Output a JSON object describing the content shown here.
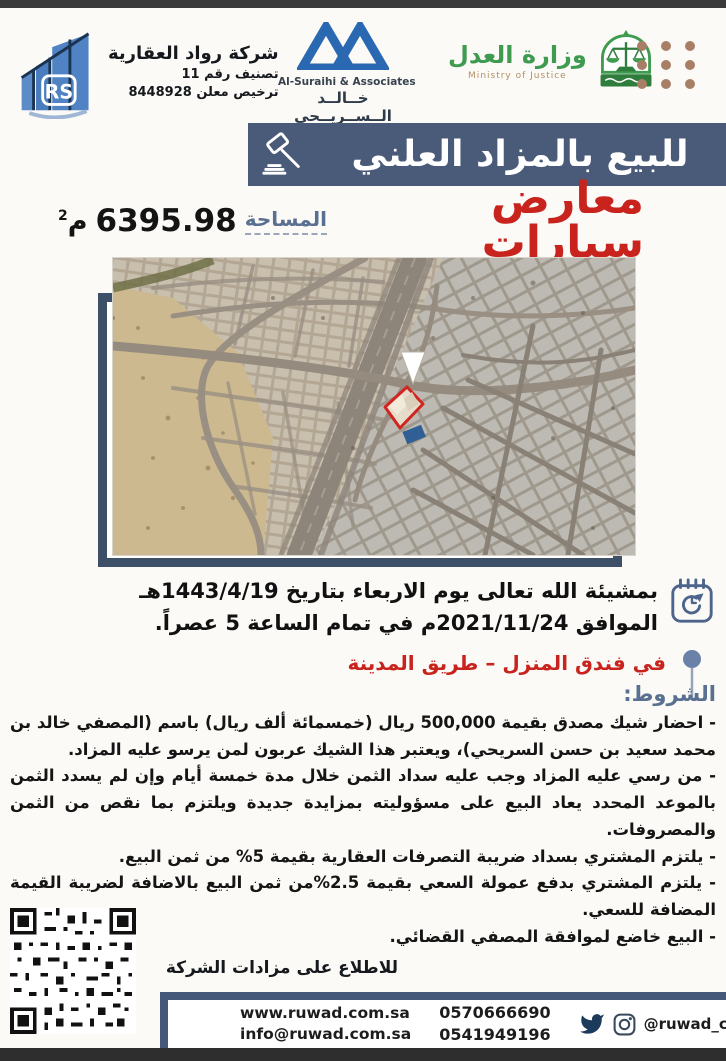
{
  "header": {
    "company": {
      "name": "شركة رواد العقارية",
      "classification": "تصنيف رقم 11",
      "license": "ترخيص معلن 8448928",
      "logo_initials": "RS"
    },
    "lawfirm": {
      "name_en": "Al-Suraihi & Associates",
      "name_ar": "خــالــد الــســريــحي",
      "tagline_ar": "محامون ومستشارون",
      "tagline_en": "Law Firm"
    },
    "ministry": {
      "name_ar": "وزارة العدل",
      "name_en": "Ministry of Justice"
    }
  },
  "banner": {
    "title": "للبيع بالمزاد العلني"
  },
  "subject": {
    "title": "معارض سيارات",
    "area_label": "المساحة",
    "area_value": "6395.98",
    "area_unit": "م",
    "area_sup": "2"
  },
  "auction": {
    "date_line1": "بمشيئة الله تعالى يوم الاربعاء بتاريخ 1443/4/19هـ",
    "date_line2": "الموافق 2021/11/24م في تمام الساعة 5 عصراً.",
    "location": "في فندق المنزل – طريق المدينة"
  },
  "conditions": {
    "heading": "الشروط:",
    "items": [
      "- احضار شيك مصدق بقيمة 500,000 ريال (خمسمائة ألف ريال) باسم (المصفي خالد بن محمد سعيد بن حسن السريحي)، ويعتبر هذا الشيك عربون لمن يرسو عليه المزاد.",
      "- من رسي عليه المزاد وجب عليه سداد الثمن خلال مدة خمسة أيام وإن لم يسدد الثمن بالموعد المحدد يعاد البيع على مسؤوليته بمزايدة جديدة ويلتزم بما نقص من الثمن والمصروفات.",
      "- يلتزم المشتري بسداد ضريبة التصرفات العقارية بقيمة 5% من ثمن البيع.",
      "- يلتزم المشتري بدفع عمولة السعي بقيمة 2.5%من ثمن البيع بالاضافة لضريبة القيمة المضافة للسعي.",
      "- البيع خاضع لموافقة المصفي القضائي."
    ]
  },
  "qr": {
    "caption": "للاطلاع على مزادات الشركة"
  },
  "footer": {
    "website": "www.ruwad.com.sa",
    "email": "info@ruwad.com.sa",
    "phone1": "0570666690",
    "phone2": "0541949196",
    "social_handle": "@ruwad_company"
  },
  "icons": {
    "gavel": "gavel-icon",
    "calendar": "calendar-clock-icon",
    "pin": "location-pin-icon",
    "twitter": "twitter-icon",
    "instagram": "instagram-icon",
    "dots": "dots-grid-decoration",
    "qr": "qr-code",
    "map_marker": "map-arrow-marker"
  },
  "colors": {
    "banner_blue": "#4a5b7a",
    "frame_blue": "#3d5068",
    "accent_red": "#c8231d",
    "heading_slate": "#5a7090",
    "ministry_green": "#3f9b4f",
    "lawfirm_blue": "#2a69b2",
    "dots_brown": "#a87f66"
  }
}
